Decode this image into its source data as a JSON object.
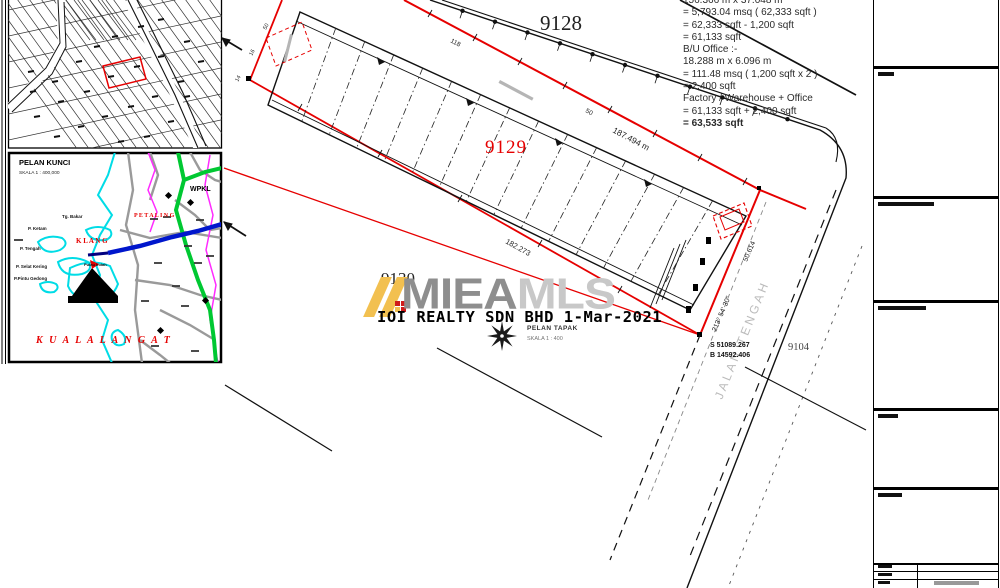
{
  "measurements": {
    "lines": [
      "156.366 m x 37.048 m",
      "= 5,793.04 msq ( 62,333 sqft )",
      "= 62,333 sqft - 1,200 sqft",
      "= 61,133 sqft",
      "B/U Office :-",
      "18.288 m x 6.096 m",
      "= 111.48 msq ( 1,200 sqft x 2 )",
      "= 2,400 sqft",
      "Factory / Warehouse + Office",
      "= 61,133 sqft + 2,400 sqft",
      "= 63,533 sqft"
    ]
  },
  "plan": {
    "lot_labels": {
      "l9128": "9128",
      "l9129": "9129",
      "l9130": "9130",
      "l9104": "9104"
    },
    "road_name": "JALAN TENGAH",
    "dims": {
      "top_length": "187.494 m",
      "bottom_length": "182.273",
      "bearing": "213° 54' 30\"",
      "bearing_dist": "50.614",
      "tick1": "118",
      "tick2": "50",
      "nw1": "50",
      "nw2": "16",
      "nw3": "14"
    },
    "coords": {
      "line1": "S 51089.267",
      "line2": "B 14592.406"
    },
    "caption": {
      "title": "PELAN TAPAK",
      "scale": "SKALA 1 : 400"
    }
  },
  "keymap": {
    "title": "PELAN KUNCI",
    "scale": "SKALA 1 : 400,000",
    "region_labels": {
      "wpkl": "WPKL",
      "klang": "K L A N G",
      "petaling": "P E T A L I N G",
      "kuala_langat": "K U A L A   L A N G A T"
    },
    "place_labels": [
      "Tg. Bakar",
      "P. Ketam",
      "P. Tengah",
      "P. Selat Kering",
      "P.Pintu Gedong",
      "Pulau Indah"
    ]
  },
  "watermark": {
    "brand_bold": "MIEA",
    "brand_light": "MLS",
    "caption": "IOI REALTY SDN BHD 1-Mar-2021"
  },
  "colors": {
    "boundary_red": "#e60000",
    "keymap_green": "#00c832",
    "keymap_blue": "#0016cc",
    "keymap_cyan": "#00dce6",
    "keymap_magenta": "#ff2bff",
    "logo_yellow": "#f2c050"
  }
}
